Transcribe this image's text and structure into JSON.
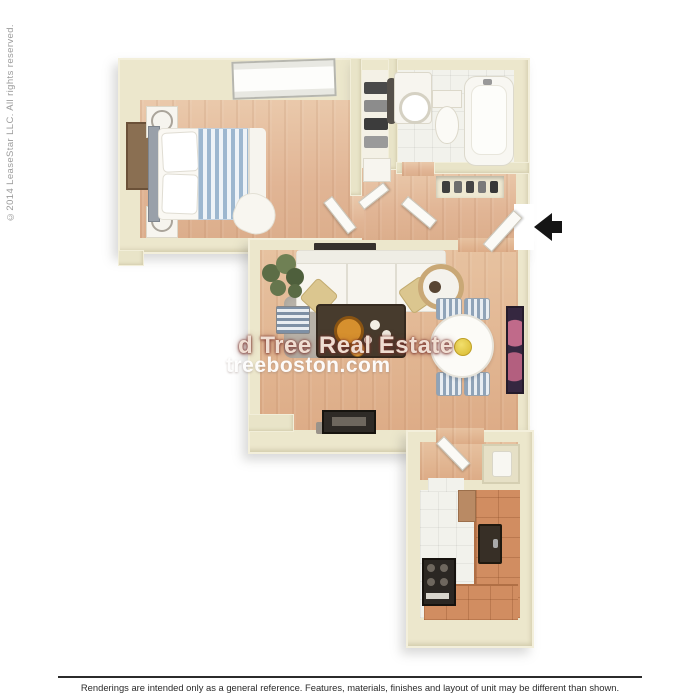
{
  "branding": {
    "copyright_vertical": "©2014 LeaseStar LLC. All rights reserved.",
    "watermark_line1": "d Tree Real Estate",
    "watermark_line2": "treeboston.com"
  },
  "footer": {
    "disclaimer": "Renderings are intended only as a general reference. Features, materials, finishes and layout of unit may be different than shown."
  },
  "floor_plan": {
    "type": "3d-top-down-apartment-floor-plan",
    "entry_arrow_direction": "left",
    "rooms": [
      {
        "name": "bedroom",
        "furniture": [
          "window",
          "bed-with-blue-striped-duvet",
          "nightstand-with-lamp-top",
          "nightstand-with-lamp-bottom",
          "dresser"
        ]
      },
      {
        "name": "closet",
        "furniture": [
          "shelves-with-linens",
          "storage-box",
          "closet-door"
        ]
      },
      {
        "name": "bathroom",
        "furniture": [
          "vanity-sink",
          "toilet",
          "bathtub",
          "hanging-towel"
        ]
      },
      {
        "name": "entry-hall",
        "furniture": [
          "shelf-niche-with-items",
          "bathroom-door",
          "front-door",
          "bedroom-door"
        ]
      },
      {
        "name": "living-room",
        "furniture": [
          "sofa-with-pillows",
          "area-rug",
          "coffee-table-with-orange-bowls",
          "potted-plant",
          "wall-art-bar",
          "round-mirror",
          "striped-ottoman",
          "tv-console"
        ]
      },
      {
        "name": "dining-area",
        "furniture": [
          "oval-dining-table",
          "four-striped-chairs",
          "pink-wall-artwork"
        ]
      },
      {
        "name": "kitchen-hall",
        "furniture": [
          "kitchen-door",
          "utility-closet"
        ]
      },
      {
        "name": "kitchen",
        "furniture": [
          "range-stove",
          "dark-sink",
          "l-shaped-terracotta-counter"
        ]
      }
    ],
    "colors": {
      "wall": "#ece7cc",
      "wall_highlight": "#f3efdb",
      "wall_shadow": "#d8d2b3",
      "wood_floor": "#e3bb9c",
      "tile_floor": "#f2f2ec",
      "counter_terracotta": "#d18d61",
      "rug": "#b8b2a8",
      "bed_stripe_blue": "#9db7cf",
      "pillow_tan": "#dbc68f",
      "artwork_accent": "#352740",
      "arrow_black": "#151515",
      "watermark_red_glow": "#7a332c"
    }
  }
}
